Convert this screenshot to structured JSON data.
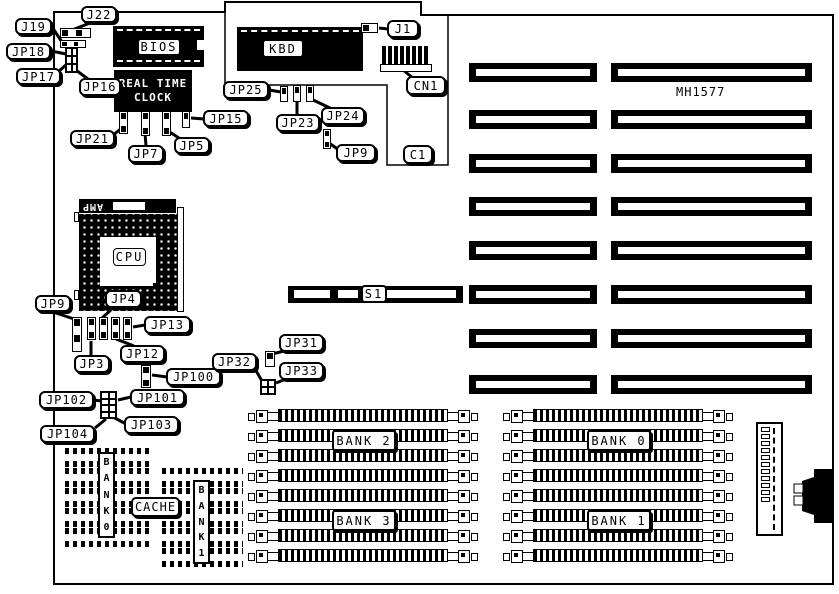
{
  "diagram": {
    "model": "MH1577",
    "chips": {
      "bios": "BIOS",
      "kbd": "KBD",
      "rtc_line1": "REAL TIME",
      "rtc_line2": "CLOCK",
      "cpu": "CPU",
      "cpu_socket_brand": "AMP",
      "cache_label": "CACHE"
    },
    "slots": {
      "s1": "S1"
    },
    "memory_banks": {
      "bank0": "BANK 0",
      "bank1": "BANK 1",
      "bank2": "BANK 2",
      "bank3": "BANK 3"
    },
    "cache_banks": {
      "bank0_vertical": "BANK0",
      "bank1_vertical": "BANK1"
    },
    "callouts": [
      {
        "id": "j22",
        "text": "J22"
      },
      {
        "id": "j19",
        "text": "J19"
      },
      {
        "id": "jp18",
        "text": "JP18"
      },
      {
        "id": "jp17",
        "text": "JP17"
      },
      {
        "id": "jp16",
        "text": "JP16"
      },
      {
        "id": "j1",
        "text": "J1"
      },
      {
        "id": "cn1",
        "text": "CN1"
      },
      {
        "id": "c1",
        "text": "C1"
      },
      {
        "id": "jp25",
        "text": "JP25"
      },
      {
        "id": "jp23",
        "text": "JP23"
      },
      {
        "id": "jp24",
        "text": "JP24"
      },
      {
        "id": "jp9t",
        "text": "JP9"
      },
      {
        "id": "jp15",
        "text": "JP15"
      },
      {
        "id": "jp21",
        "text": "JP21"
      },
      {
        "id": "jp7",
        "text": "JP7"
      },
      {
        "id": "jp5",
        "text": "JP5"
      },
      {
        "id": "jp9l",
        "text": "JP9"
      },
      {
        "id": "jp4",
        "text": "JP4"
      },
      {
        "id": "jp13",
        "text": "JP13"
      },
      {
        "id": "jp3",
        "text": "JP3"
      },
      {
        "id": "jp12",
        "text": "JP12"
      },
      {
        "id": "jp100",
        "text": "JP100"
      },
      {
        "id": "jp101",
        "text": "JP101"
      },
      {
        "id": "jp102",
        "text": "JP102"
      },
      {
        "id": "jp103",
        "text": "JP103"
      },
      {
        "id": "jp104",
        "text": "JP104"
      },
      {
        "id": "jp31",
        "text": "JP31"
      },
      {
        "id": "jp32",
        "text": "JP32"
      },
      {
        "id": "jp33",
        "text": "JP33"
      }
    ]
  }
}
